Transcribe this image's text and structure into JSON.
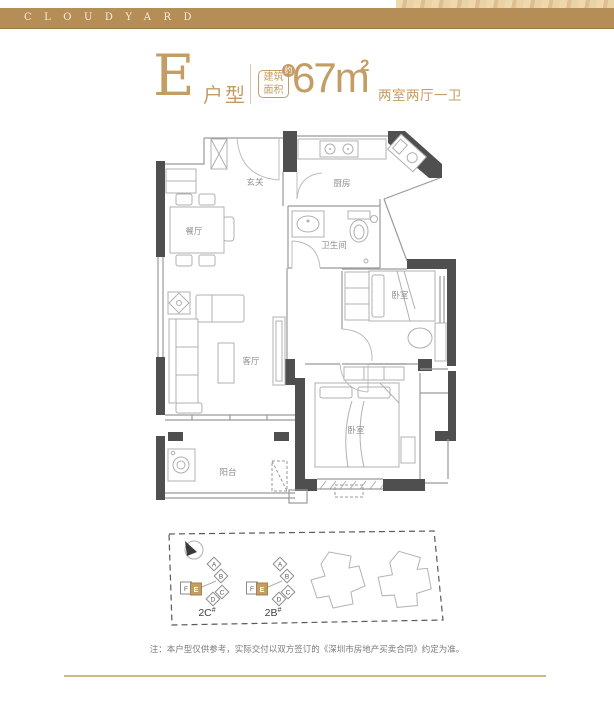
{
  "header": {
    "brand": "CLOUDYARD"
  },
  "title": {
    "unit_letter": "E",
    "unit_type_label": "户型",
    "area_badge_line1": "建筑",
    "area_badge_line2": "面积",
    "area_badge_approx": "约",
    "area_value": "67m",
    "area_sup": "2",
    "layout_label": "两室两厅一卫"
  },
  "floorplan": {
    "rooms": [
      {
        "name": "玄关"
      },
      {
        "name": "厨房"
      },
      {
        "name": "餐厅"
      },
      {
        "name": "卫生间"
      },
      {
        "name": "客厅"
      },
      {
        "name": "卧室"
      },
      {
        "name": "卧室"
      },
      {
        "name": "阳台"
      }
    ]
  },
  "siteplan": {
    "buildings": [
      {
        "label": "2C",
        "sup": "#"
      },
      {
        "label": "2B",
        "sup": "#"
      }
    ],
    "units": [
      "A",
      "B",
      "C",
      "D",
      "E",
      "F"
    ],
    "highlighted_unit": "E"
  },
  "note": "注：本户型仅供参考，实际交付以双方签订的《深圳市房地产买卖合同》约定为准。",
  "colors": {
    "gold": "#c49d64",
    "band": "#b48d57",
    "wall": "#4f4f4f"
  }
}
